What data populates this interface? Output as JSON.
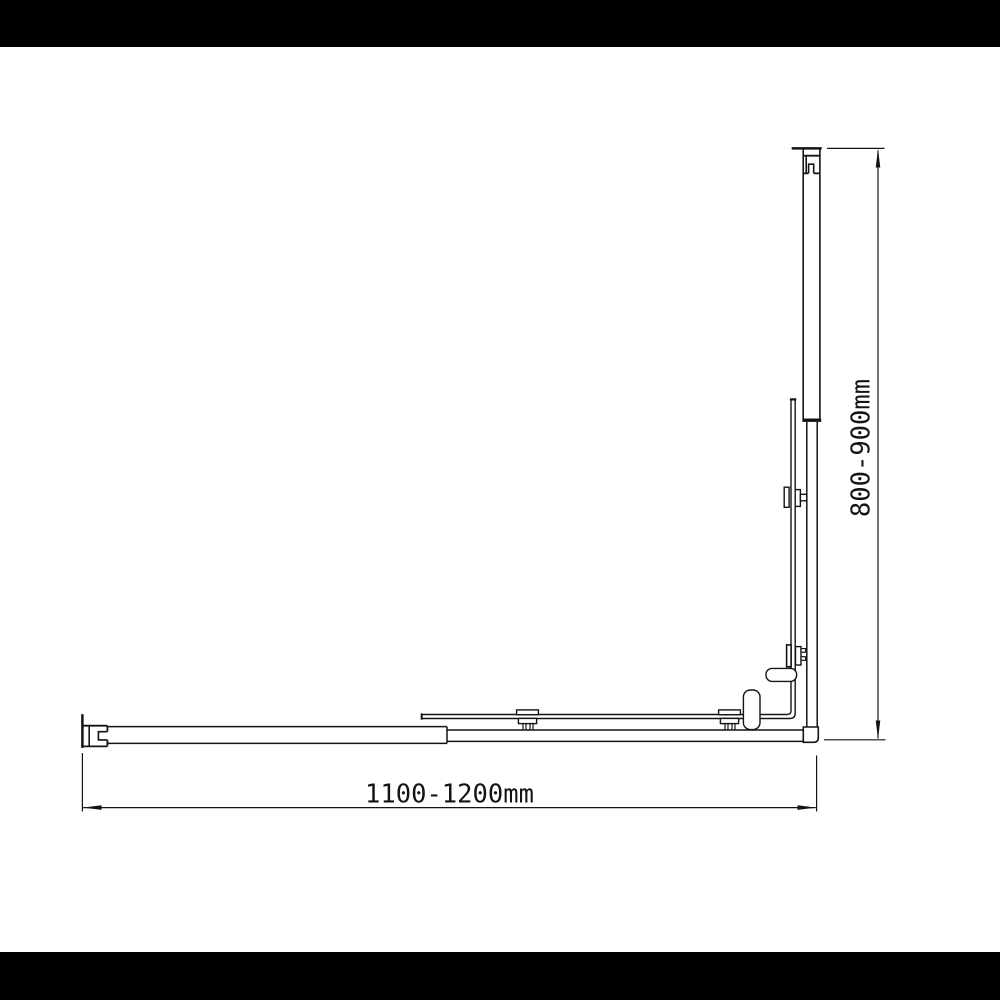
{
  "colors": {
    "background": "#ffffff",
    "letterbox": "#000000",
    "line": "#141414"
  },
  "dimensions": {
    "width_label": "1100-1200mm",
    "height_label": "800-900mm"
  },
  "drawing": {
    "type": "technical plan-view line drawing",
    "parts": [
      "top-wall-profile",
      "right-wall-rail",
      "right-glass-panel",
      "right-panel-clamp-upper",
      "right-panel-clamp-lower",
      "door-handle",
      "door-knob",
      "corner-foot",
      "left-wall-profile",
      "bottom-fixed-rail",
      "bottom-door-rail",
      "bottom-glass-panel",
      "bottom-roller-clamp-left",
      "bottom-roller-clamp-right",
      "width-dimension",
      "height-dimension"
    ]
  }
}
